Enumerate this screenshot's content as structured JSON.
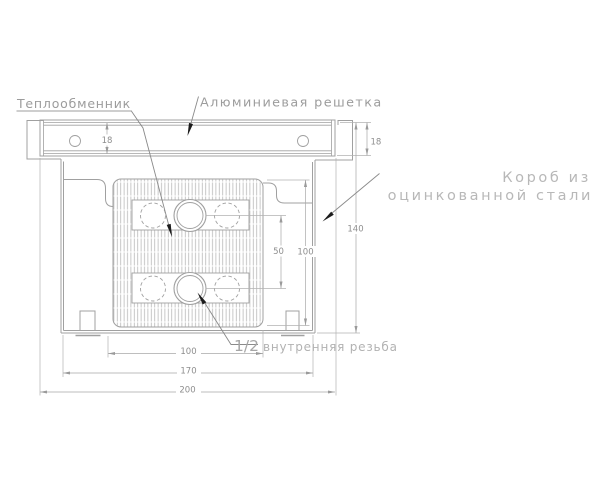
{
  "title": "Convector cross-section drawing",
  "labels": {
    "heat_exchanger": "Теплообменник",
    "aluminum_grille": "Алюминиевая решетка",
    "box_line1": "Короб из",
    "box_line2": "оцинкованной стали",
    "thread_size": "1/2",
    "thread_text": "внутренняя резьба"
  },
  "dimensions": {
    "grille_height_left": "18",
    "grille_height_right": "18",
    "total_height": "140",
    "exchanger_height": "100",
    "pipe_spacing": "50",
    "exchanger_width": "100",
    "box_width": "170",
    "total_width": "200"
  },
  "colors": {
    "line": "#a8a8a8",
    "hatch": "#b4b4b4",
    "dim_text": "#8e8e8e",
    "label_text": "#9c9c9c",
    "light_label_text": "#b8b8b8",
    "leader_arrow": "#1c1c1c",
    "background": "#ffffff"
  }
}
